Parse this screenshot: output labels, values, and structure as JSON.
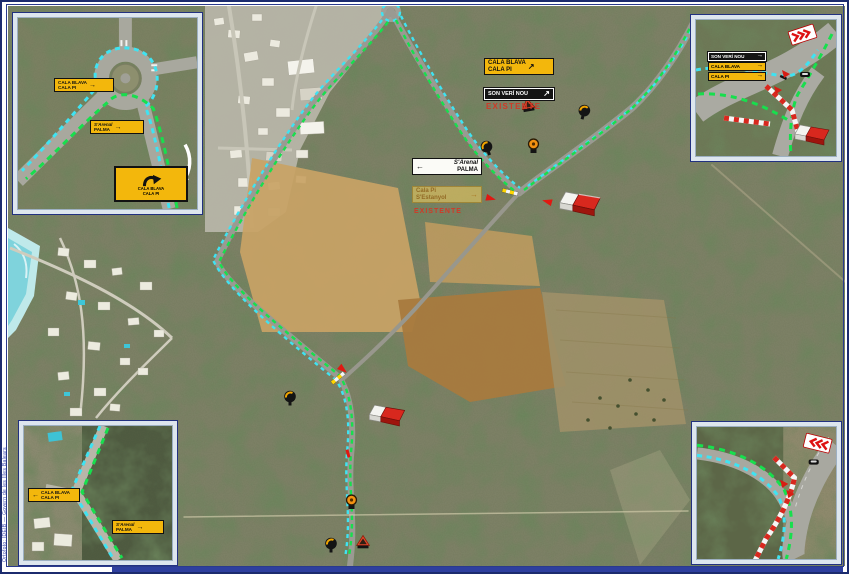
{
  "frame": {
    "border_color": "#1c2b6e",
    "bottom_band_color": "#2e3f9e"
  },
  "colors": {
    "route_green": "#17df4d",
    "route_cyan": "#3fe3f2",
    "sign_yellow": "#f3b70c",
    "sign_black": "#141414",
    "barrier_red": "#d8281e",
    "note_red": "#cf3a28"
  },
  "glyphs": {
    "arrow_right": "→",
    "arrow_left": "←",
    "arrow_up_right": "↗"
  },
  "credit": "Ortofoto: IDEIB — Govern de les Illes Balears",
  "signs": {
    "dest_main": {
      "l1": "CALA BLAVA",
      "l2": "CALA PI"
    },
    "son_veri": "SON VERÍ NOU",
    "note_existing_1": "EXISTENTE",
    "arenal": {
      "l1": "S'Arenal",
      "l2": "PALMA"
    },
    "faded": {
      "l1": "Cala Pi",
      "l2": "S'Estanyol"
    },
    "note_existing_2": "EXISTENTE"
  },
  "inset_tl": {
    "s1": {
      "l1": "CALA BLAVA",
      "l2": "CALA PI"
    },
    "s2": {
      "l1": "S'Arenal",
      "l2": "PALMA"
    },
    "s3": {
      "l1": "CALA BLAVA",
      "l2": "CALA PI"
    }
  },
  "inset_tr": {
    "rows": [
      {
        "label": "SON VERÍ NOU"
      },
      {
        "label": "CALA BLAVA"
      },
      {
        "label": "CALA PI"
      }
    ]
  },
  "inset_bl": {
    "s1": {
      "l1": "CALA BLAVA",
      "l2": "CALA PI"
    },
    "s2": {
      "l1": "S'Arenal",
      "l2": "PALMA"
    }
  }
}
